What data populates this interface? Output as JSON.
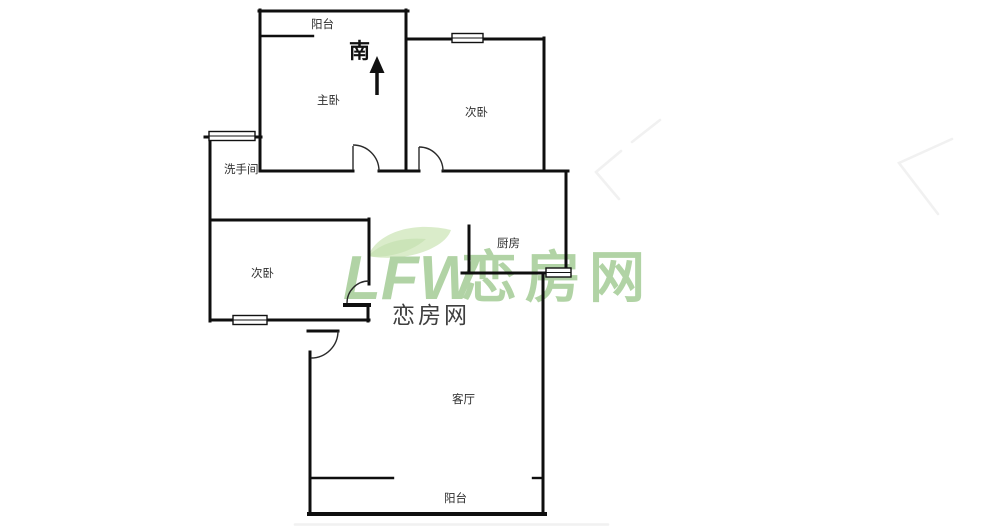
{
  "page": {
    "type": "real-estate floor plan screenshot",
    "background_color": "#ffffff"
  },
  "rooms": {
    "balcony_top": "阳台",
    "master_bedroom": "主卧",
    "bedroom_right": "次卧",
    "bathroom": "洗手间",
    "bedroom_left": "次卧",
    "kitchen": "厨房",
    "living_room": "客厅",
    "balcony_bottom": "阳台"
  },
  "compass": {
    "direction_label": "南"
  },
  "watermark": {
    "logo_text": "LFW",
    "site_name": "恋房网",
    "text_color": "#abd09e",
    "leaf_color": "#cde4b8"
  },
  "center_label": {
    "text": "恋房网",
    "color": "#3f3f3f"
  },
  "colors": {
    "wall": "#0f0f0f",
    "room_label": "#2e2e2e"
  }
}
